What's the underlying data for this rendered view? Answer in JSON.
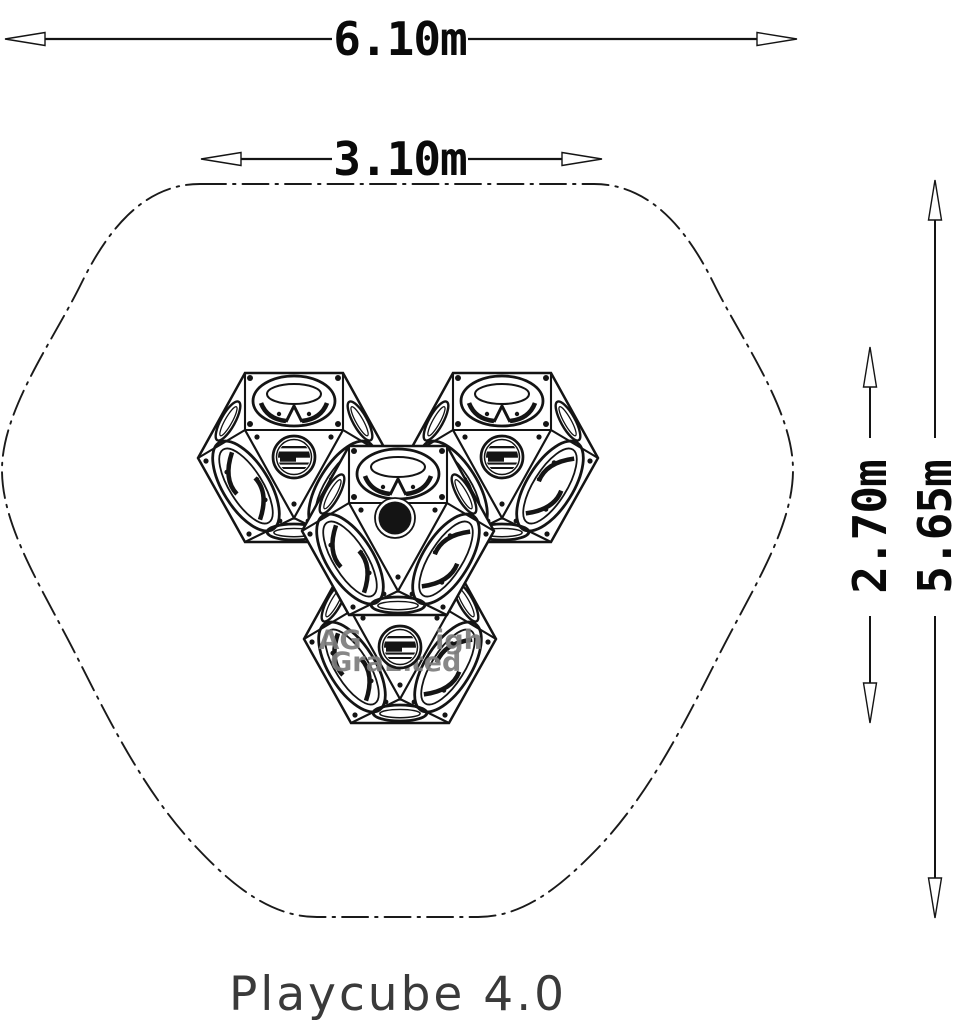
{
  "diagram": {
    "product_title": "Playcube 4.0",
    "dimensions": {
      "overall_width": "6.10m",
      "structure_width": "3.10m",
      "structure_height": "2.70m",
      "overall_height": "5.65m"
    },
    "watermark": {
      "frag_1": "AG",
      "frag_2": "igh",
      "frag_3": "Gra",
      "frag_4": "El",
      "frag_5": "ted"
    },
    "colors": {
      "line": "#141414",
      "dimension_text": "#0a0a0a",
      "watermark": "#7d7d7d",
      "title": "#3a3a3a",
      "background": "#ffffff"
    }
  }
}
